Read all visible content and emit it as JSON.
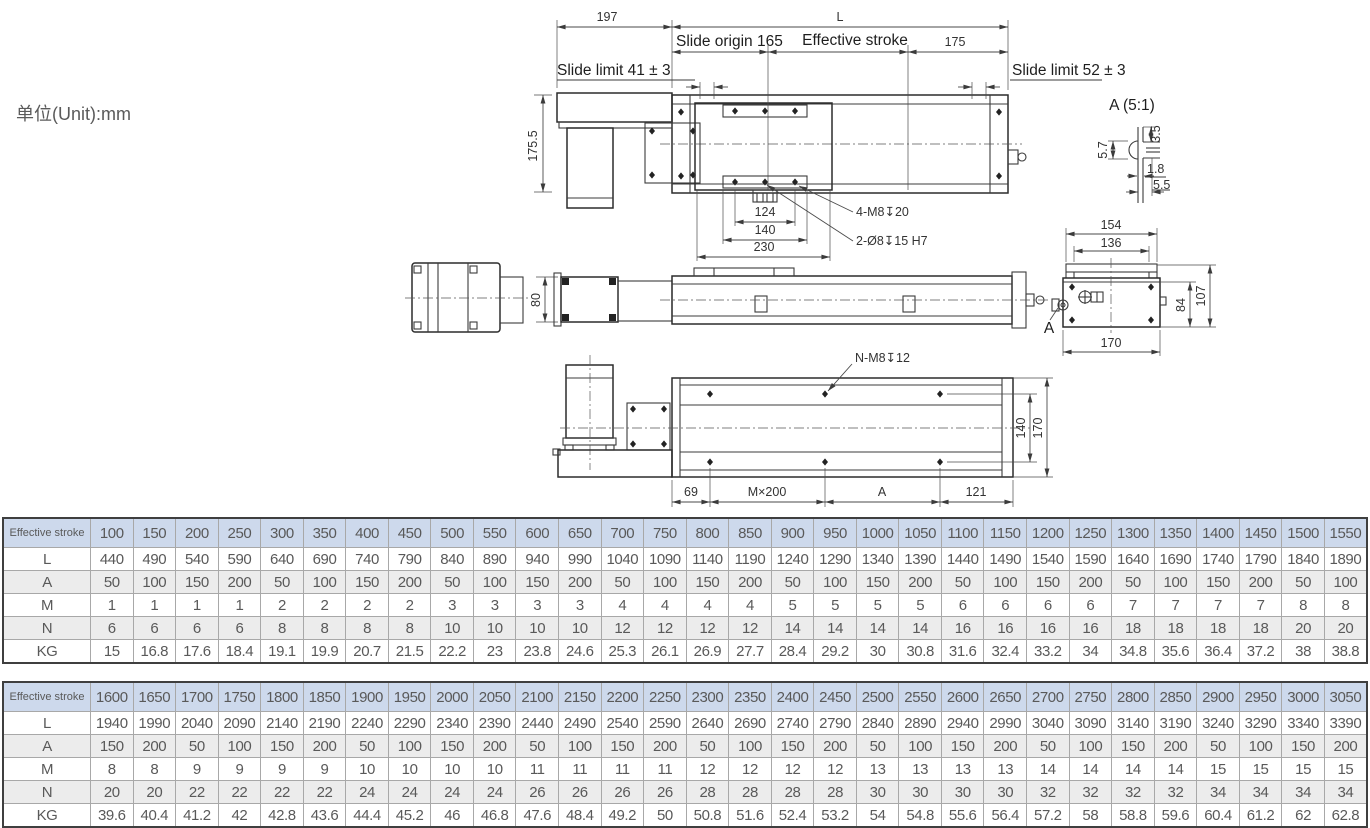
{
  "unit_label": "单位(Unit):mm",
  "colors": {
    "header_blue": "#cdd9ec",
    "row_gray": "#ececec",
    "line": "#3b3b3b",
    "text_gray": "#595959"
  },
  "drawing": {
    "plan": {
      "d197": "197",
      "dL": "L",
      "slide_origin": "Slide origin 165",
      "effective_stroke": "Effective stroke",
      "d175": "175",
      "limit_left": "Slide limit 41 ± 3",
      "limit_right": "Slide limit 52 ± 3",
      "d175_5": "175.5",
      "d124": "124",
      "d140": "140",
      "d230": "230",
      "note_4m8": "4-M8↧20",
      "note_2o8": "2-Ø8↧15 H7"
    },
    "detail_a": {
      "title": "A (5:1)",
      "d57": "5.7",
      "d35": "3.5",
      "d18": "1.8",
      "d55": "5.5"
    },
    "side": {
      "d80": "80"
    },
    "end": {
      "d154": "154",
      "d136": "136",
      "d84": "84",
      "d107": "107",
      "d170": "170",
      "label_a": "A"
    },
    "bottom": {
      "note_nm8": "N-M8↧12",
      "d140": "140",
      "d170": "170",
      "d69": "69",
      "dM200": "M×200",
      "dA": "A",
      "d121": "121"
    }
  },
  "tables": [
    {
      "header_label": "Effective stroke",
      "strokes": [
        100,
        150,
        200,
        250,
        300,
        350,
        400,
        450,
        500,
        550,
        600,
        650,
        700,
        750,
        800,
        850,
        900,
        950,
        1000,
        1050,
        1100,
        1150,
        1200,
        1250,
        1300,
        1350,
        1400,
        1450,
        1500,
        1550
      ],
      "rows": [
        {
          "label": "L",
          "values": [
            440,
            490,
            540,
            590,
            640,
            690,
            740,
            790,
            840,
            890,
            940,
            990,
            1040,
            1090,
            1140,
            1190,
            1240,
            1290,
            1340,
            1390,
            1440,
            1490,
            1540,
            1590,
            1640,
            1690,
            1740,
            1790,
            1840,
            1890
          ]
        },
        {
          "label": "A",
          "values": [
            50,
            100,
            150,
            200,
            50,
            100,
            150,
            200,
            50,
            100,
            150,
            200,
            50,
            100,
            150,
            200,
            50,
            100,
            150,
            200,
            50,
            100,
            150,
            200,
            50,
            100,
            150,
            200,
            50,
            100
          ]
        },
        {
          "label": "M",
          "values": [
            1,
            1,
            1,
            1,
            2,
            2,
            2,
            2,
            3,
            3,
            3,
            3,
            4,
            4,
            4,
            4,
            5,
            5,
            5,
            5,
            6,
            6,
            6,
            6,
            7,
            7,
            7,
            7,
            8,
            8
          ]
        },
        {
          "label": "N",
          "values": [
            6,
            6,
            6,
            6,
            8,
            8,
            8,
            8,
            10,
            10,
            10,
            10,
            12,
            12,
            12,
            12,
            14,
            14,
            14,
            14,
            16,
            16,
            16,
            16,
            18,
            18,
            18,
            18,
            20,
            20
          ]
        },
        {
          "label": "KG",
          "values": [
            15,
            16.8,
            17.6,
            18.4,
            19.1,
            19.9,
            20.7,
            21.5,
            22.2,
            23,
            23.8,
            24.6,
            25.3,
            26.1,
            26.9,
            27.7,
            28.4,
            29.2,
            30,
            30.8,
            31.6,
            32.4,
            33.2,
            34,
            34.8,
            35.6,
            36.4,
            37.2,
            38,
            38.8
          ]
        }
      ]
    },
    {
      "header_label": "Effective stroke",
      "strokes": [
        1600,
        1650,
        1700,
        1750,
        1800,
        1850,
        1900,
        1950,
        2000,
        2050,
        2100,
        2150,
        2200,
        2250,
        2300,
        2350,
        2400,
        2450,
        2500,
        2550,
        2600,
        2650,
        2700,
        2750,
        2800,
        2850,
        2900,
        2950,
        3000,
        3050
      ],
      "rows": [
        {
          "label": "L",
          "values": [
            1940,
            1990,
            2040,
            2090,
            2140,
            2190,
            2240,
            2290,
            2340,
            2390,
            2440,
            2490,
            2540,
            2590,
            2640,
            2690,
            2740,
            2790,
            2840,
            2890,
            2940,
            2990,
            3040,
            3090,
            3140,
            3190,
            3240,
            3290,
            3340,
            3390
          ]
        },
        {
          "label": "A",
          "values": [
            150,
            200,
            50,
            100,
            150,
            200,
            50,
            100,
            150,
            200,
            50,
            100,
            150,
            200,
            50,
            100,
            150,
            200,
            50,
            100,
            150,
            200,
            50,
            100,
            150,
            200,
            50,
            100,
            150,
            200
          ]
        },
        {
          "label": "M",
          "values": [
            8,
            8,
            9,
            9,
            9,
            9,
            10,
            10,
            10,
            10,
            11,
            11,
            11,
            11,
            12,
            12,
            12,
            12,
            13,
            13,
            13,
            13,
            14,
            14,
            14,
            14,
            15,
            15,
            15,
            15
          ]
        },
        {
          "label": "N",
          "values": [
            20,
            20,
            22,
            22,
            22,
            22,
            24,
            24,
            24,
            24,
            26,
            26,
            26,
            26,
            28,
            28,
            28,
            28,
            30,
            30,
            30,
            30,
            32,
            32,
            32,
            32,
            34,
            34,
            34,
            34
          ]
        },
        {
          "label": "KG",
          "values": [
            39.6,
            40.4,
            41.2,
            42,
            42.8,
            43.6,
            44.4,
            45.2,
            46,
            46.8,
            47.6,
            48.4,
            49.2,
            50,
            50.8,
            51.6,
            52.4,
            53.2,
            54,
            54.8,
            55.6,
            56.4,
            57.2,
            58,
            58.8,
            59.6,
            60.4,
            61.2,
            62,
            62.8
          ]
        }
      ]
    }
  ]
}
